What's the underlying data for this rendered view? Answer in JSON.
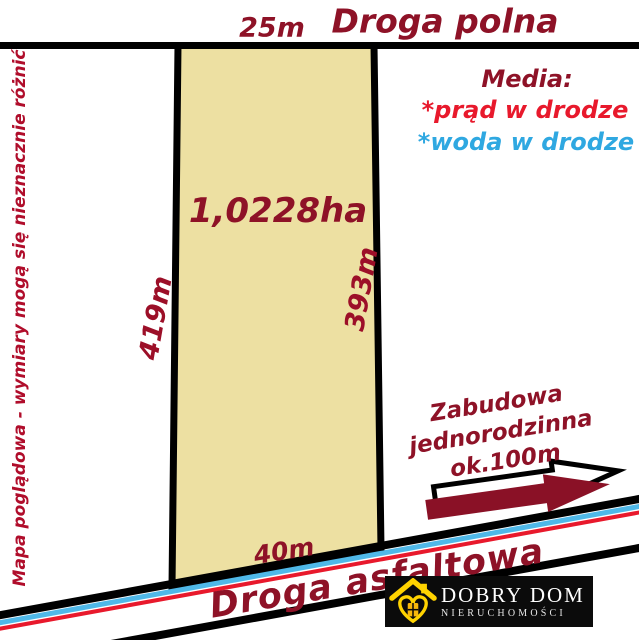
{
  "colors": {
    "maroon_text": "#8E1227",
    "dim_text": "#9C0F28",
    "disclaimer_text": "#B00D2B",
    "electric_red": "#E8192C",
    "water_blue": "#2FA8E1",
    "road_line_blue": "#4FB8E8",
    "road_line_red": "#E8192C",
    "parcel_fill": "#EDE0A2",
    "arrow_fill": "#8A1126",
    "logo_bg": "#0b0b0b",
    "logo_yellow": "#FFD300"
  },
  "top_road": {
    "width_label": "25m",
    "name": "Droga polna"
  },
  "media": {
    "heading": "Media:",
    "items": [
      {
        "text": "*prąd w drodze",
        "color": "#E8192C"
      },
      {
        "text": "*woda w drodze",
        "color": "#2FA8E1"
      }
    ]
  },
  "disclaimer": "Mapa poglądowa - wymiary mogą się nieznacznie różnić",
  "parcel": {
    "area_label": "1,0228ha",
    "left_dimension": "419m",
    "right_dimension": "393m",
    "bottom_dimension": "40m"
  },
  "annotation": {
    "line1": "Zabudowa",
    "line2": "jednorodzinna",
    "line3": "ok.100m",
    "arrow_icon": "right-arrow-icon"
  },
  "bottom_road": {
    "name": "Droga asfaltowa"
  },
  "logo": {
    "icon": "house-heart-icon",
    "name": "DOBRY DOM",
    "subtitle": "NIERUCHOMOŚCI"
  }
}
